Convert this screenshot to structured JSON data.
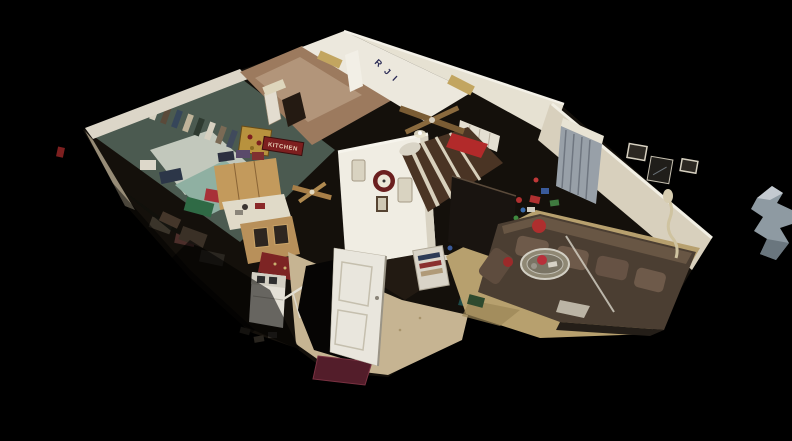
{
  "scene": {
    "view": "3D dollhouse cutaway of a single-story home interior, tilted overhead angle, floating on black",
    "background": "#000000",
    "text": {
      "kitchen_sign": "KITCHEN",
      "wall_letters": "R J I"
    },
    "colors": {
      "background_black": "#000000",
      "wall_white": "#ece8dd",
      "wall_cream": "#d8d0bd",
      "wall_tan": "#9c7a5e",
      "bedroom_teal_floor": "#4b5a50",
      "cabinet_wood": "#c39a5c",
      "counter_white": "#e0dac8",
      "carpet_tan": "#b7a06e",
      "couch_brown": "#4b3e32",
      "cushion_brown": "#6e5a4a",
      "bed_comforter_brown": "#4a3424",
      "bed_blanket_red": "#b22a2a",
      "clock_maroon": "#6b1f1f",
      "sign_red": "#7d1f1f",
      "letters_navy": "#2a2a55",
      "tile_beige": "#c6b492",
      "entry_rug_maroon": "#531d2a",
      "kitchen_rug_red": "#7d2424",
      "door_white": "#e9e6dd",
      "blinds_gray": "#98a0a8",
      "washer_white": "#e4e0d6",
      "fan_blade_wood": "#7a5c34",
      "fragment_gray": "#8e9aa2"
    },
    "rooms": [
      {
        "name": "messy-bedroom-left",
        "items": "closet with hanging clothes, piles of clothing in teal/red/green/white"
      },
      {
        "name": "kids-room-top",
        "items": "gold window valances, white door, navy wall letters"
      },
      {
        "name": "bathroom-hall",
        "items": "tan walls, small framed art, gold ornate panel"
      },
      {
        "name": "kitchen",
        "items": "oak cabinets, cluttered counter, red KITCHEN wall sign, red rug, white washing machine"
      },
      {
        "name": "master-bedroom",
        "items": "striped brown/white comforter, red blanket, white headboard, maroon wall clock, ornate frames, ceiling fan"
      },
      {
        "name": "living-room",
        "items": "brown sectional sofa, red pillow, glass coffee table, vertical blinds, framed pictures, dark TV stand, bike and toys, beige floor lamp, tan carpet"
      },
      {
        "name": "entryway",
        "items": "open white door, tiled floor, maroon rug, stair railing, shelf with clothes, teal towel"
      }
    ]
  }
}
